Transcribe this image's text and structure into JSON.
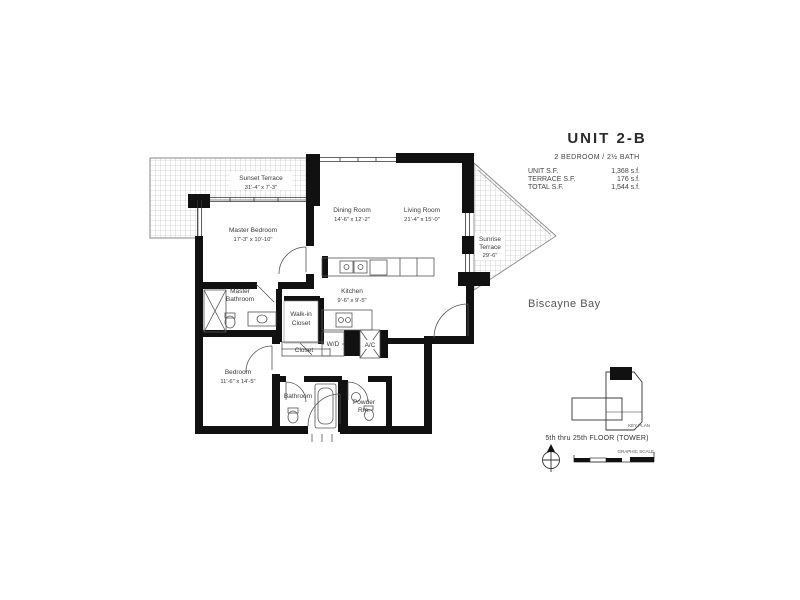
{
  "header": {
    "unit_title": "UNIT 2-B",
    "unit_subtitle": "2 BEDROOM / 2½ BATH",
    "area_rows": [
      {
        "label": "UNIT S.F.",
        "value": "1,368 s.f."
      },
      {
        "label": "TERRACE S.F.",
        "value": "176 s.f."
      },
      {
        "label": "TOTAL S.F.",
        "value": "1,544 s.f."
      }
    ]
  },
  "plan": {
    "rooms": [
      {
        "lines": [
          "Sunset Terrace",
          "31'-4\" x 7'-3\""
        ]
      },
      {
        "lines": [
          "Master Bedroom",
          "17'-3\" x 10'-10\""
        ]
      },
      {
        "lines": [
          "Dining Room",
          "14'-6\" x 12'-2\""
        ]
      },
      {
        "lines": [
          "Living Room",
          "21'-4\" x 15'-0\""
        ]
      },
      {
        "lines": [
          "Kitchen",
          "9'-6\" x 9'-5\""
        ]
      },
      {
        "lines": [
          "Master",
          "Bathroom"
        ]
      },
      {
        "lines": [
          "Walk-in",
          "Closet"
        ]
      },
      {
        "lines": [
          "Closet"
        ]
      },
      {
        "lines": [
          "Bedroom",
          "11'-6\" x 14'-5\""
        ]
      },
      {
        "lines": [
          "Bathroom"
        ]
      },
      {
        "lines": [
          "Powder",
          "Rm."
        ]
      },
      {
        "lines": [
          "Sunrise",
          "Terrace",
          "29'-6\""
        ]
      },
      {
        "lines": [
          "W/D"
        ]
      },
      {
        "lines": [
          "A/C"
        ]
      }
    ]
  },
  "annotations": {
    "water_label": "Biscayne Bay",
    "floor_note": "5th thru 25th FLOOR (TOWER)",
    "key_plan_label": "KEY PLAN",
    "scale_label": "GRAPHIC SCALE"
  },
  "colors": {
    "wall": "#111111",
    "hatch": "#b8b8b8",
    "text": "#3a3a3a"
  }
}
